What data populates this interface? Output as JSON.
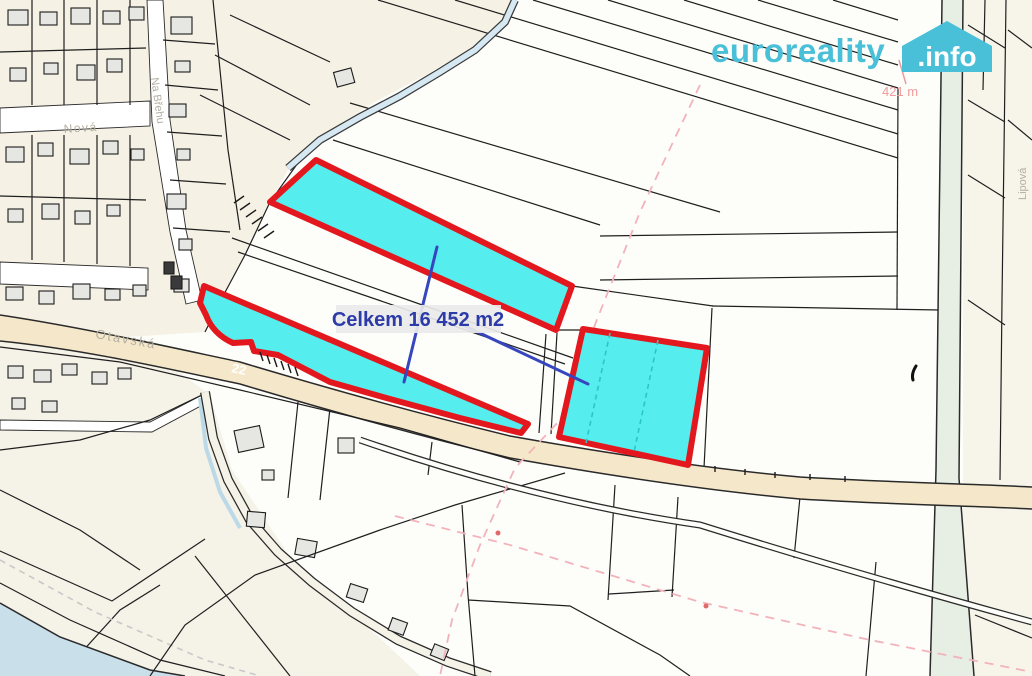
{
  "watermark": {
    "brand": "euroreality",
    "suffix": ".info",
    "brand_color": "#49BFD8",
    "suffix_color": "#FFFFFF"
  },
  "annotations": {
    "total_area_label": "Celkem 16 452 m2",
    "distance_label": "421 m"
  },
  "streets": {
    "main_road_name": "Otavská",
    "main_road_number": "22",
    "street_1": "Nová",
    "street_2": "Na Břehu",
    "street_3": "Lipová"
  },
  "colors": {
    "highlight_fill": "#55EDED",
    "highlight_stroke": "#E3181E",
    "area_label_color": "#2C3BA8",
    "pointer_color": "#3546BE",
    "distance_color": "#EE9C9C",
    "road_fill": "#F5E7C9",
    "water_fill": "#C9DFEA",
    "street_label_color": "#B3AFA1"
  }
}
